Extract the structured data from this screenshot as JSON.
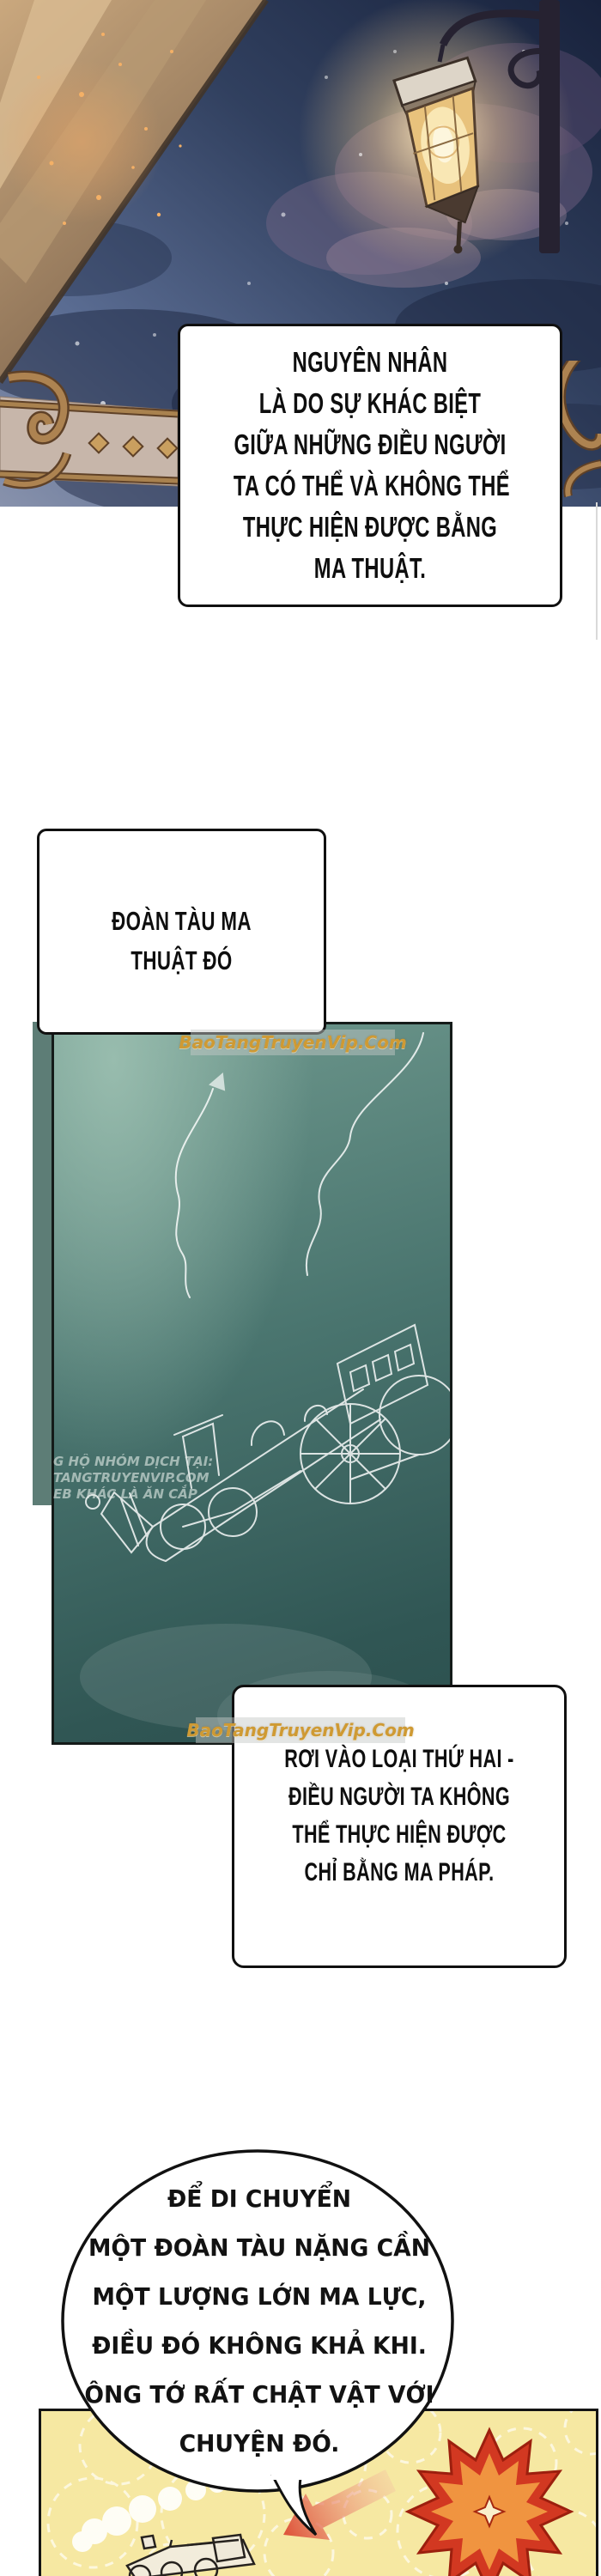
{
  "watermarks": {
    "site_top": "BaoTangTruyenVip.Com",
    "site_bottom": "BaoTangTruyenVip.Com",
    "translator_note_lines": [
      "G HỘ NHÓM DỊCH TẠI:",
      "TANGTRUYENVIP.COM",
      "EB KHÁC LÀ ĂN CẮP"
    ]
  },
  "bubbles": {
    "b1": {
      "lines": [
        "NGUYÊN NHÂN",
        "LÀ DO SỰ KHÁC BIỆT",
        "GIỮA NHỮNG ĐIỀU NGƯỜI",
        "TA CÓ THỂ VÀ KHÔNG THỂ",
        "THỰC HIỆN ĐƯỢC BẰNG",
        "MA THUẬT."
      ]
    },
    "b2": {
      "lines": [
        "ĐOÀN TÀU MA",
        "THUẬT ĐÓ"
      ]
    },
    "b3": {
      "lines": [
        "RƠI VÀO LOẠI THỨ HAI -",
        "ĐIỀU NGƯỜI TA KHÔNG",
        "THỂ THỰC HIỆN ĐƯỢC",
        "CHỈ BẰNG MA PHÁP."
      ]
    },
    "b4": {
      "lines": [
        "ĐỂ DI CHUYỂN",
        "MỘT ĐOÀN TÀU NẶNG CẦN",
        "MỘT LƯỢNG LỚN MA LỰC,",
        "ĐIỀU ĐÓ KHÔNG KHẢ KHI.",
        "ÔNG TỚ RẤT CHẬT VẬT VỚI",
        "CHUYỆN ĐÓ."
      ]
    }
  },
  "colors": {
    "sky_dark": "#18223c",
    "sky_light": "#8892ac",
    "teal_panel": "#4a756f",
    "watermark_gold": "#cf9a33",
    "yellow_panel": "#f6e8a2",
    "burst_red": "#d23821",
    "burst_orange": "#f09440",
    "lantern_glow": "#ffe9bd"
  }
}
